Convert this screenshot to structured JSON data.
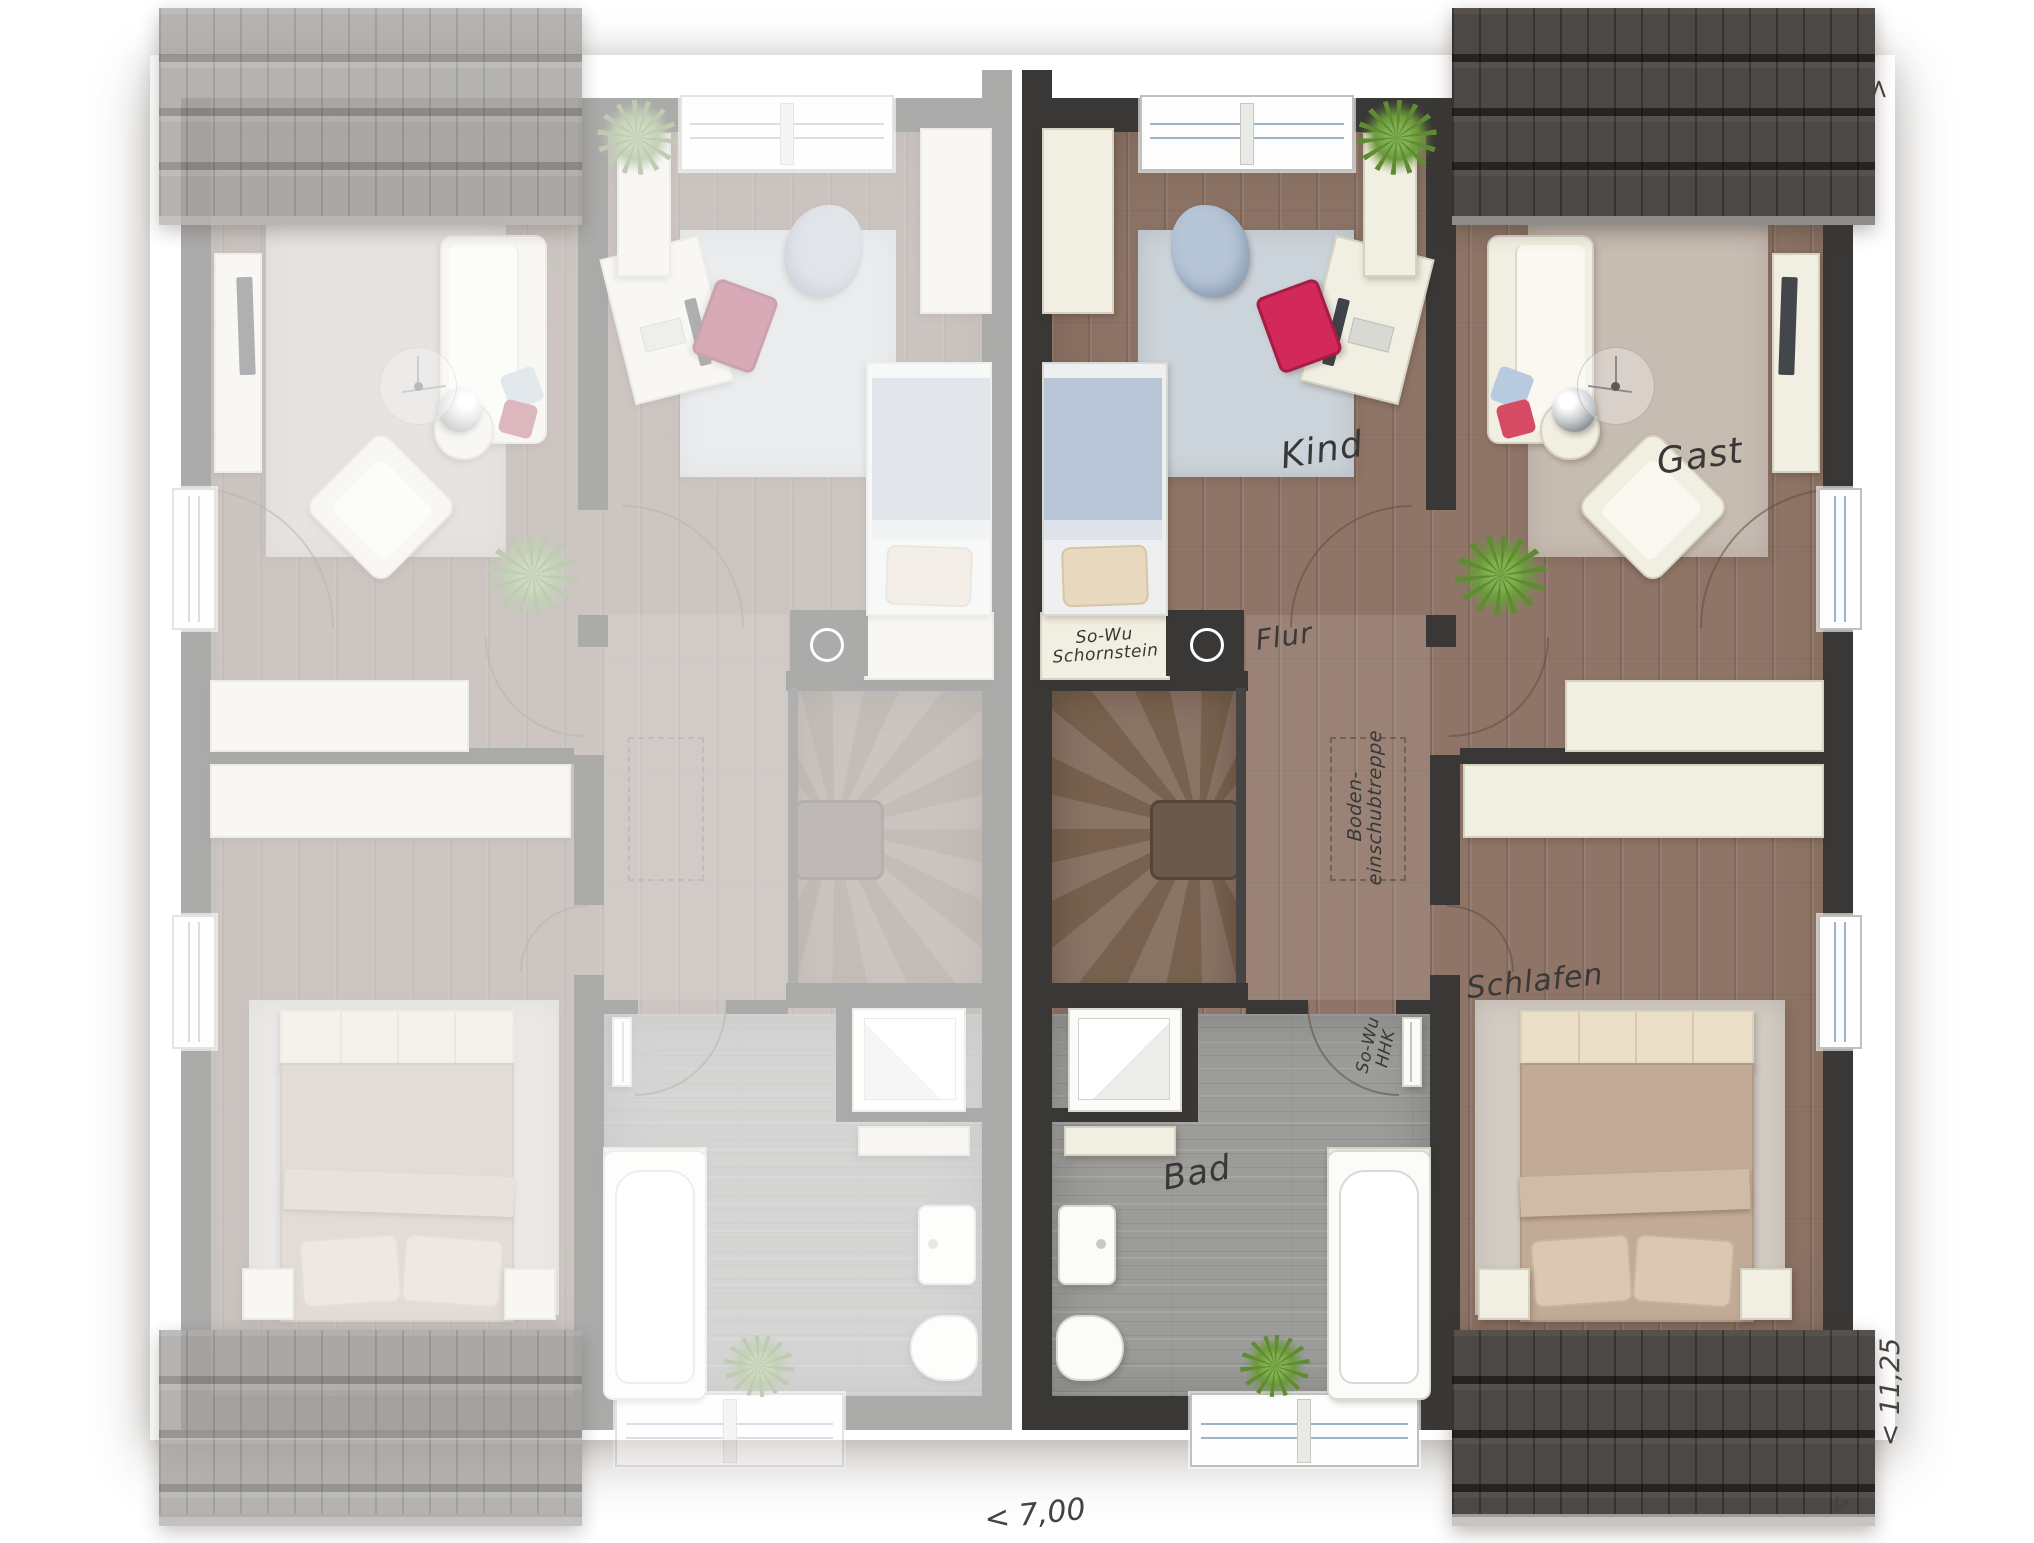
{
  "rooms": {
    "kind": "Kind",
    "gast": "Gast",
    "flur": "Flur",
    "bad": "Bad",
    "schlafen": "Schlafen"
  },
  "annotations": {
    "chimney": {
      "line1": "So-Wu",
      "line2": "Schornstein"
    },
    "attic_stairs": {
      "line1": "Boden-",
      "line2": "einschubtreppe"
    },
    "hhk": {
      "line1": "So-Wu",
      "line2": "HHK"
    }
  },
  "dimensions": {
    "unit_width": "< 7,00",
    "building_depth": "< 11,25",
    "chevron_top": ">",
    "chevron_bottom": ">"
  },
  "colors": {
    "wall": "#3a3836",
    "wood_floor": "#8e7567",
    "bath_floor": "#9c9c9a",
    "roof_dark": "#4c4845",
    "roof_light": "#a3a19e",
    "rug_kind": "#ccd4db",
    "rug_gast": "#c7bcb2",
    "rug_schlafen": "#d3ccc4",
    "chair_accent": "#d2285a",
    "furniture_cream": "#f1eee2",
    "label_ink": "#3a3836"
  }
}
